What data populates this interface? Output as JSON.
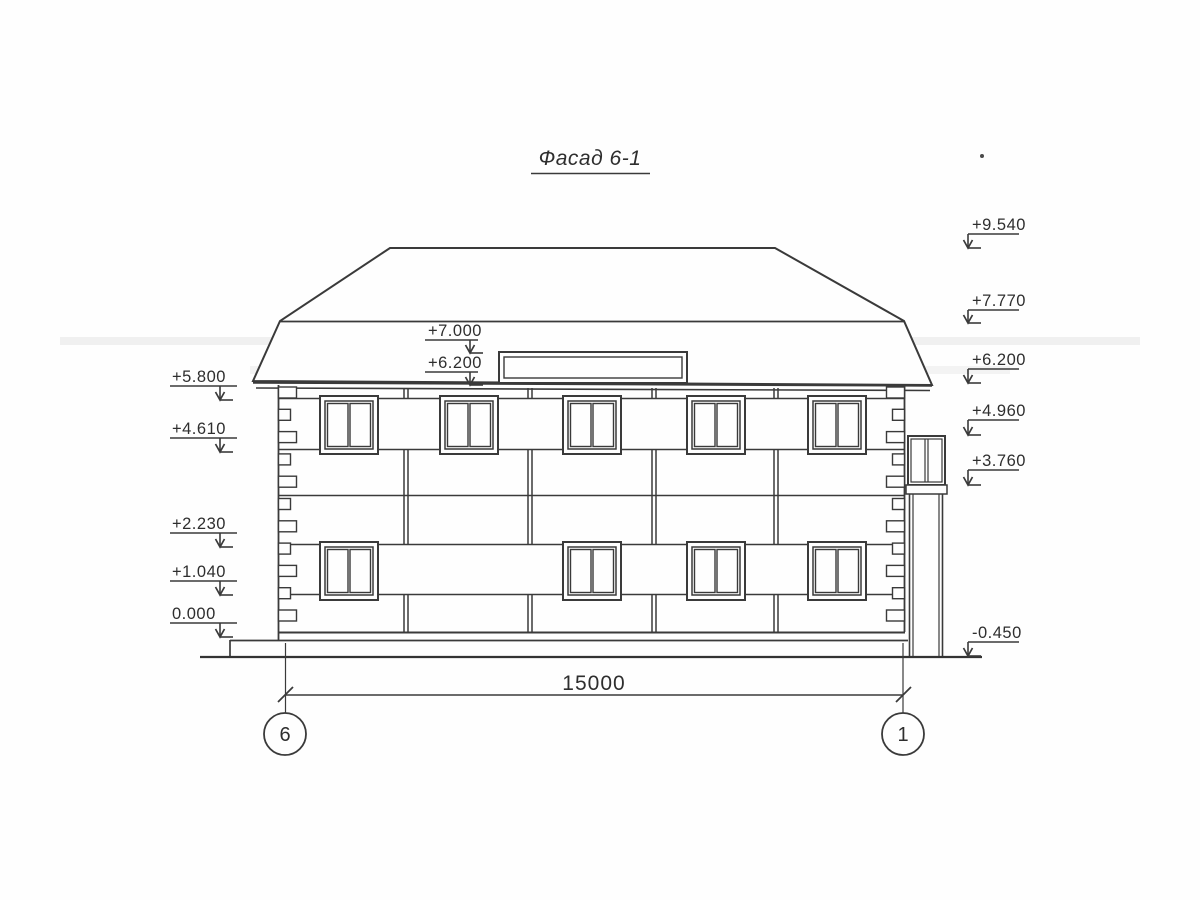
{
  "drawing": {
    "title": "Фасад 6-1",
    "dimension_label": "15000",
    "axis_left": "6",
    "axis_right": "1",
    "ink_color": "#3a3a3a"
  },
  "elevation_marks": {
    "left": [
      {
        "label": "+5.800",
        "shelf_y": 386,
        "tip_y": 400
      },
      {
        "label": "+4.610",
        "shelf_y": 438,
        "tip_y": 452
      },
      {
        "label": "+2.230",
        "shelf_y": 533,
        "tip_y": 547
      },
      {
        "label": "+1.040",
        "shelf_y": 581,
        "tip_y": 595
      },
      {
        "label": "0.000",
        "shelf_y": 623,
        "tip_y": 637
      }
    ],
    "center": [
      {
        "label": "+7.000",
        "shelf_y": 340,
        "tip_y": 353
      },
      {
        "label": "+6.200",
        "shelf_y": 372,
        "tip_y": 385
      }
    ],
    "right": [
      {
        "label": "+9.540",
        "shelf_y": 234,
        "tip_y": 248
      },
      {
        "label": "+7.770",
        "shelf_y": 310,
        "tip_y": 323
      },
      {
        "label": "+6.200",
        "shelf_y": 369,
        "tip_y": 383
      },
      {
        "label": "+4.960",
        "shelf_y": 420,
        "tip_y": 435
      },
      {
        "label": "+3.760",
        "shelf_y": 470,
        "tip_y": 485
      },
      {
        "label": "-0.450",
        "shelf_y": 642,
        "tip_y": 656
      }
    ]
  }
}
